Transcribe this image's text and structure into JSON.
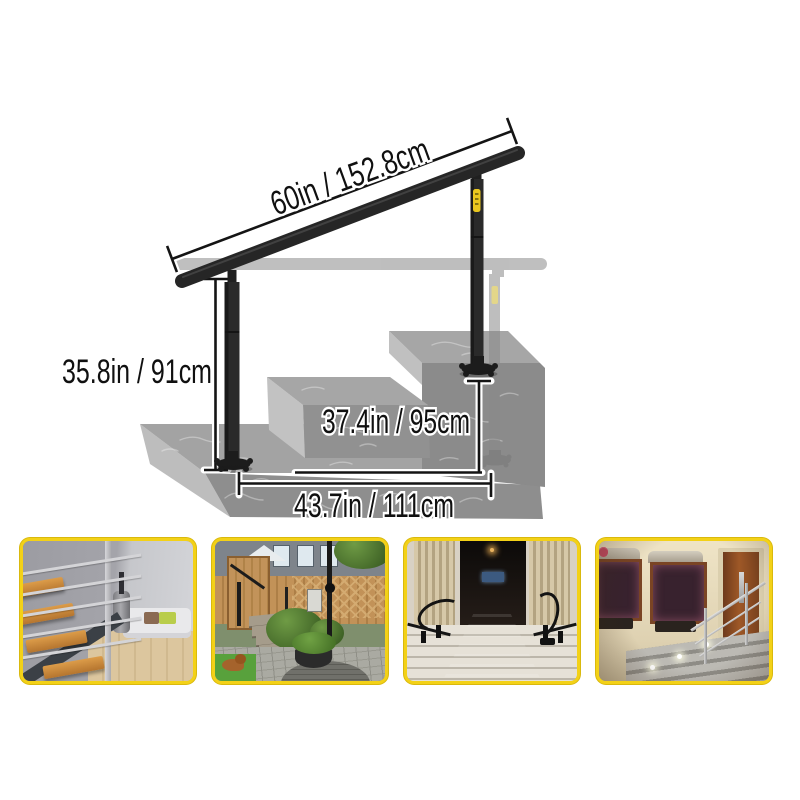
{
  "page": {
    "background": "#ffffff"
  },
  "diagram": {
    "labels": {
      "rail_length": "60in / 152.8cm",
      "post_height": "35.8in / 91cm",
      "upper_height": "37.4in / 95cm",
      "base_width": "43.7in / 111cm"
    },
    "colors": {
      "rail_black": "#262626",
      "ghost_gray": "#8a8a8a",
      "step_top": "#a5a5a5",
      "step_front": "#8e8e8e",
      "step_side": "#c0c0c0",
      "brand_tag_yellow": "#e9c71f",
      "dimension_line": "#141414"
    }
  },
  "gallery": {
    "border_color": "#f3d117",
    "photos": [
      {
        "id": "indoor-staircase",
        "description": "Indoor wooden stairs with stainless steel railing beside a living room"
      },
      {
        "id": "garden-steps",
        "description": "Backyard stone steps with black handrails, wooden fence, plants and a dog"
      },
      {
        "id": "red-carpet-entrance",
        "description": "Grand columned entrance with ornate railings and a red carpet on the steps"
      },
      {
        "id": "evening-entrance",
        "description": "Evening house entrance with flower window boxes, wooden door and steel stair railing"
      }
    ]
  }
}
